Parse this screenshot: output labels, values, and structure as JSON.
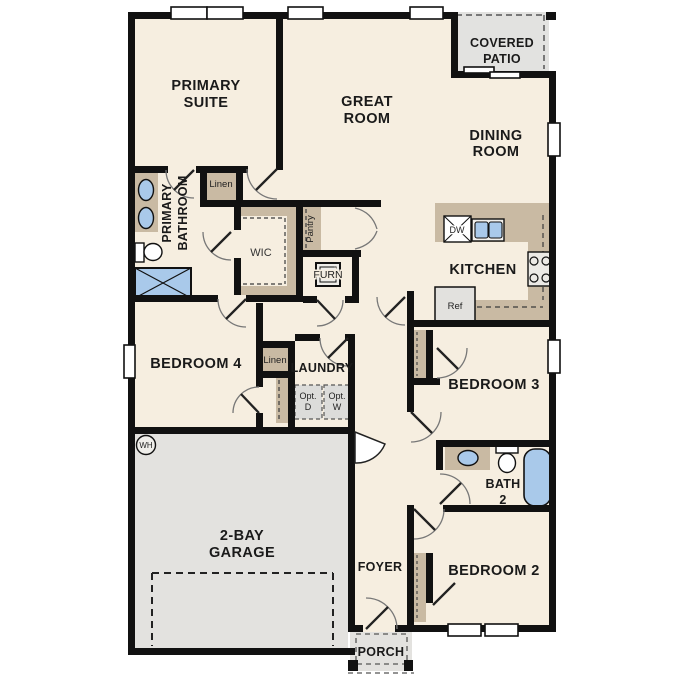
{
  "colors": {
    "wall": "#111111",
    "floor": "#f6eee0",
    "casework": "#c9baa3",
    "garage_floor": "#e3e2df",
    "patio_floor": "#e2e2e0",
    "fixture_blue": "#a9c9ea",
    "option_box": "#dcdcda"
  },
  "rooms": {
    "primary_suite": {
      "line1": "PRIMARY",
      "line2": "SUITE"
    },
    "great_room": {
      "line1": "GREAT",
      "line2": "ROOM"
    },
    "dining_room": {
      "line1": "DINING",
      "line2": "ROOM"
    },
    "covered_patio": {
      "line1": "COVERED",
      "line2": "PATIO"
    },
    "kitchen": {
      "label": "KITCHEN"
    },
    "primary_bathroom": {
      "line1": "PRIMARY",
      "line2": "BATHROOM"
    },
    "wic": {
      "label": "WIC"
    },
    "bedroom4": {
      "label": "BEDROOM 4"
    },
    "laundry": {
      "label": "LAUNDRY"
    },
    "garage": {
      "line1": "2-BAY",
      "line2": "GARAGE"
    },
    "foyer": {
      "label": "FOYER"
    },
    "porch": {
      "label": "PORCH"
    },
    "bedroom3": {
      "label": "BEDROOM 3"
    },
    "bath2": {
      "line1": "BATH",
      "line2": "2"
    },
    "bedroom2": {
      "label": "BEDROOM 2"
    }
  },
  "closets": {
    "linen_primary": "Linen",
    "linen_hall": "Linen",
    "pantry": "Pantry"
  },
  "equipment": {
    "furnace": "FURN",
    "water_heater": "WH",
    "refrigerator": "Ref",
    "dishwasher": "DW"
  },
  "options": {
    "dryer_line1": "Opt.",
    "dryer_line2": "D",
    "washer_line1": "Opt.",
    "washer_line2": "W"
  }
}
